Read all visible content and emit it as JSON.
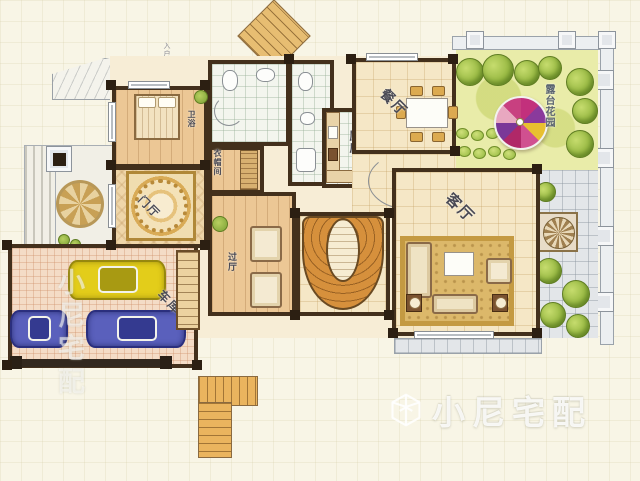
{
  "labels": {
    "dining": "餐厅",
    "living": "客厅",
    "kitchen": "厨房",
    "foyer": "门厅",
    "hall": "过厅",
    "garage": "车库",
    "cloakroom": "衣帽间",
    "bath": "卫浴",
    "terrace_garden": "露台花园",
    "entry_annotation": "入户花园"
  },
  "watermark": {
    "brand": "小尼宅配",
    "side_brand": "小尼宅配"
  },
  "colors": {
    "background": "#f8f5e6",
    "wall": "#43301c",
    "floor_tile": "#f5e7c6",
    "wood_floor": "#ecc795",
    "stair_orange": "#d6903c",
    "garden_green": "#e9eca9",
    "tree_green": "#8fb23a",
    "terrace_gray": "#e3e6e9",
    "car_yellow": "#e3cd1a",
    "car_blue": "#5a60bc",
    "parasol_magenta": "#c2307c",
    "parasol_purple": "#8a3a9c",
    "parasol_yellow": "#e8c030",
    "rug_gold": "#dcb86a"
  },
  "objects": {
    "cars": [
      {
        "name": "yellow-car",
        "color": "#e3cd1a"
      },
      {
        "name": "blue-car-left",
        "color": "#5a60bc"
      },
      {
        "name": "blue-car-right",
        "color": "#5a60bc"
      }
    ],
    "furniture": [
      "bed",
      "dining-table-6-chairs",
      "sofa-set",
      "armchairs",
      "wardrobe"
    ],
    "features": [
      "horseshoe-staircase",
      "exterior-l-staircase",
      "diagonal-staircase",
      "garage-door",
      "parasol",
      "floor-medallion",
      "trees"
    ]
  }
}
